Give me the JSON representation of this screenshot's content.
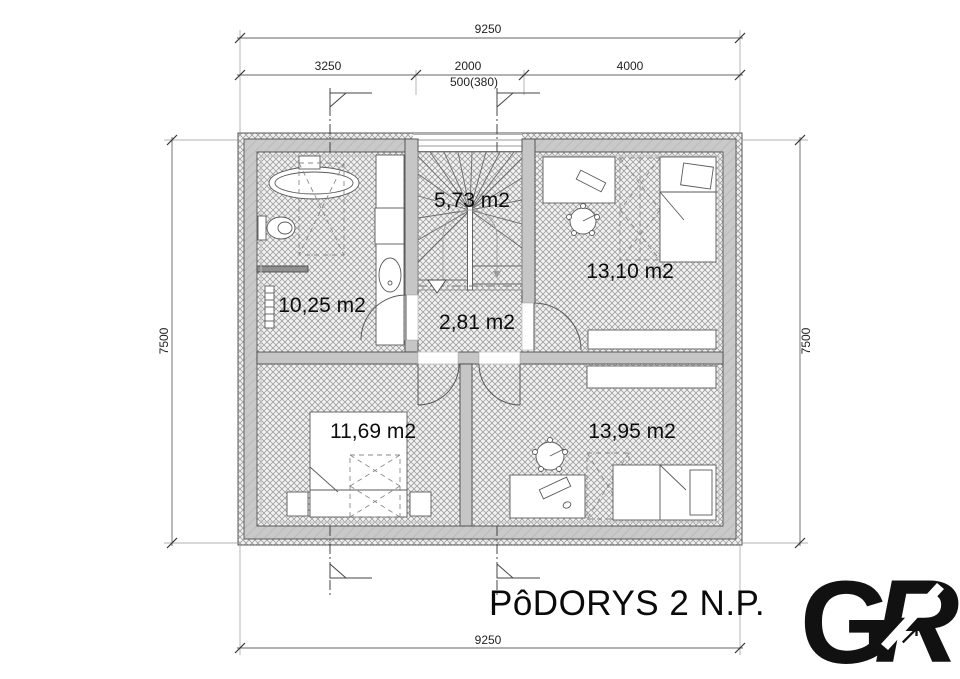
{
  "title": "PôDORYS 2 N.P.",
  "dimensions": {
    "top_total": "9250",
    "seg_left": "3250",
    "seg_mid": "2000",
    "seg_mid_sub": "500(380)",
    "seg_right": "4000",
    "left_total": "7500",
    "right_total": "7500",
    "bottom_total": "9250"
  },
  "rooms": [
    {
      "name": "staircase",
      "area": "5,73 m2"
    },
    {
      "name": "bathroom",
      "area": "10,25 m2"
    },
    {
      "name": "bedroom-top-right",
      "area": "13,10 m2"
    },
    {
      "name": "hallway",
      "area": "2,81 m2"
    },
    {
      "name": "bedroom-bottom-left",
      "area": "11,69 m2"
    },
    {
      "name": "bedroom-bottom-right",
      "area": "13,95 m2"
    }
  ],
  "logo": {
    "letter_g": "G",
    "letter_r": "R",
    "arrow": "↗"
  },
  "colors": {
    "wall_fill": "#c7c7c7",
    "line": "#444444",
    "logo_teal": "#2ab5c9",
    "logo_silver": "#9a9a9a"
  }
}
